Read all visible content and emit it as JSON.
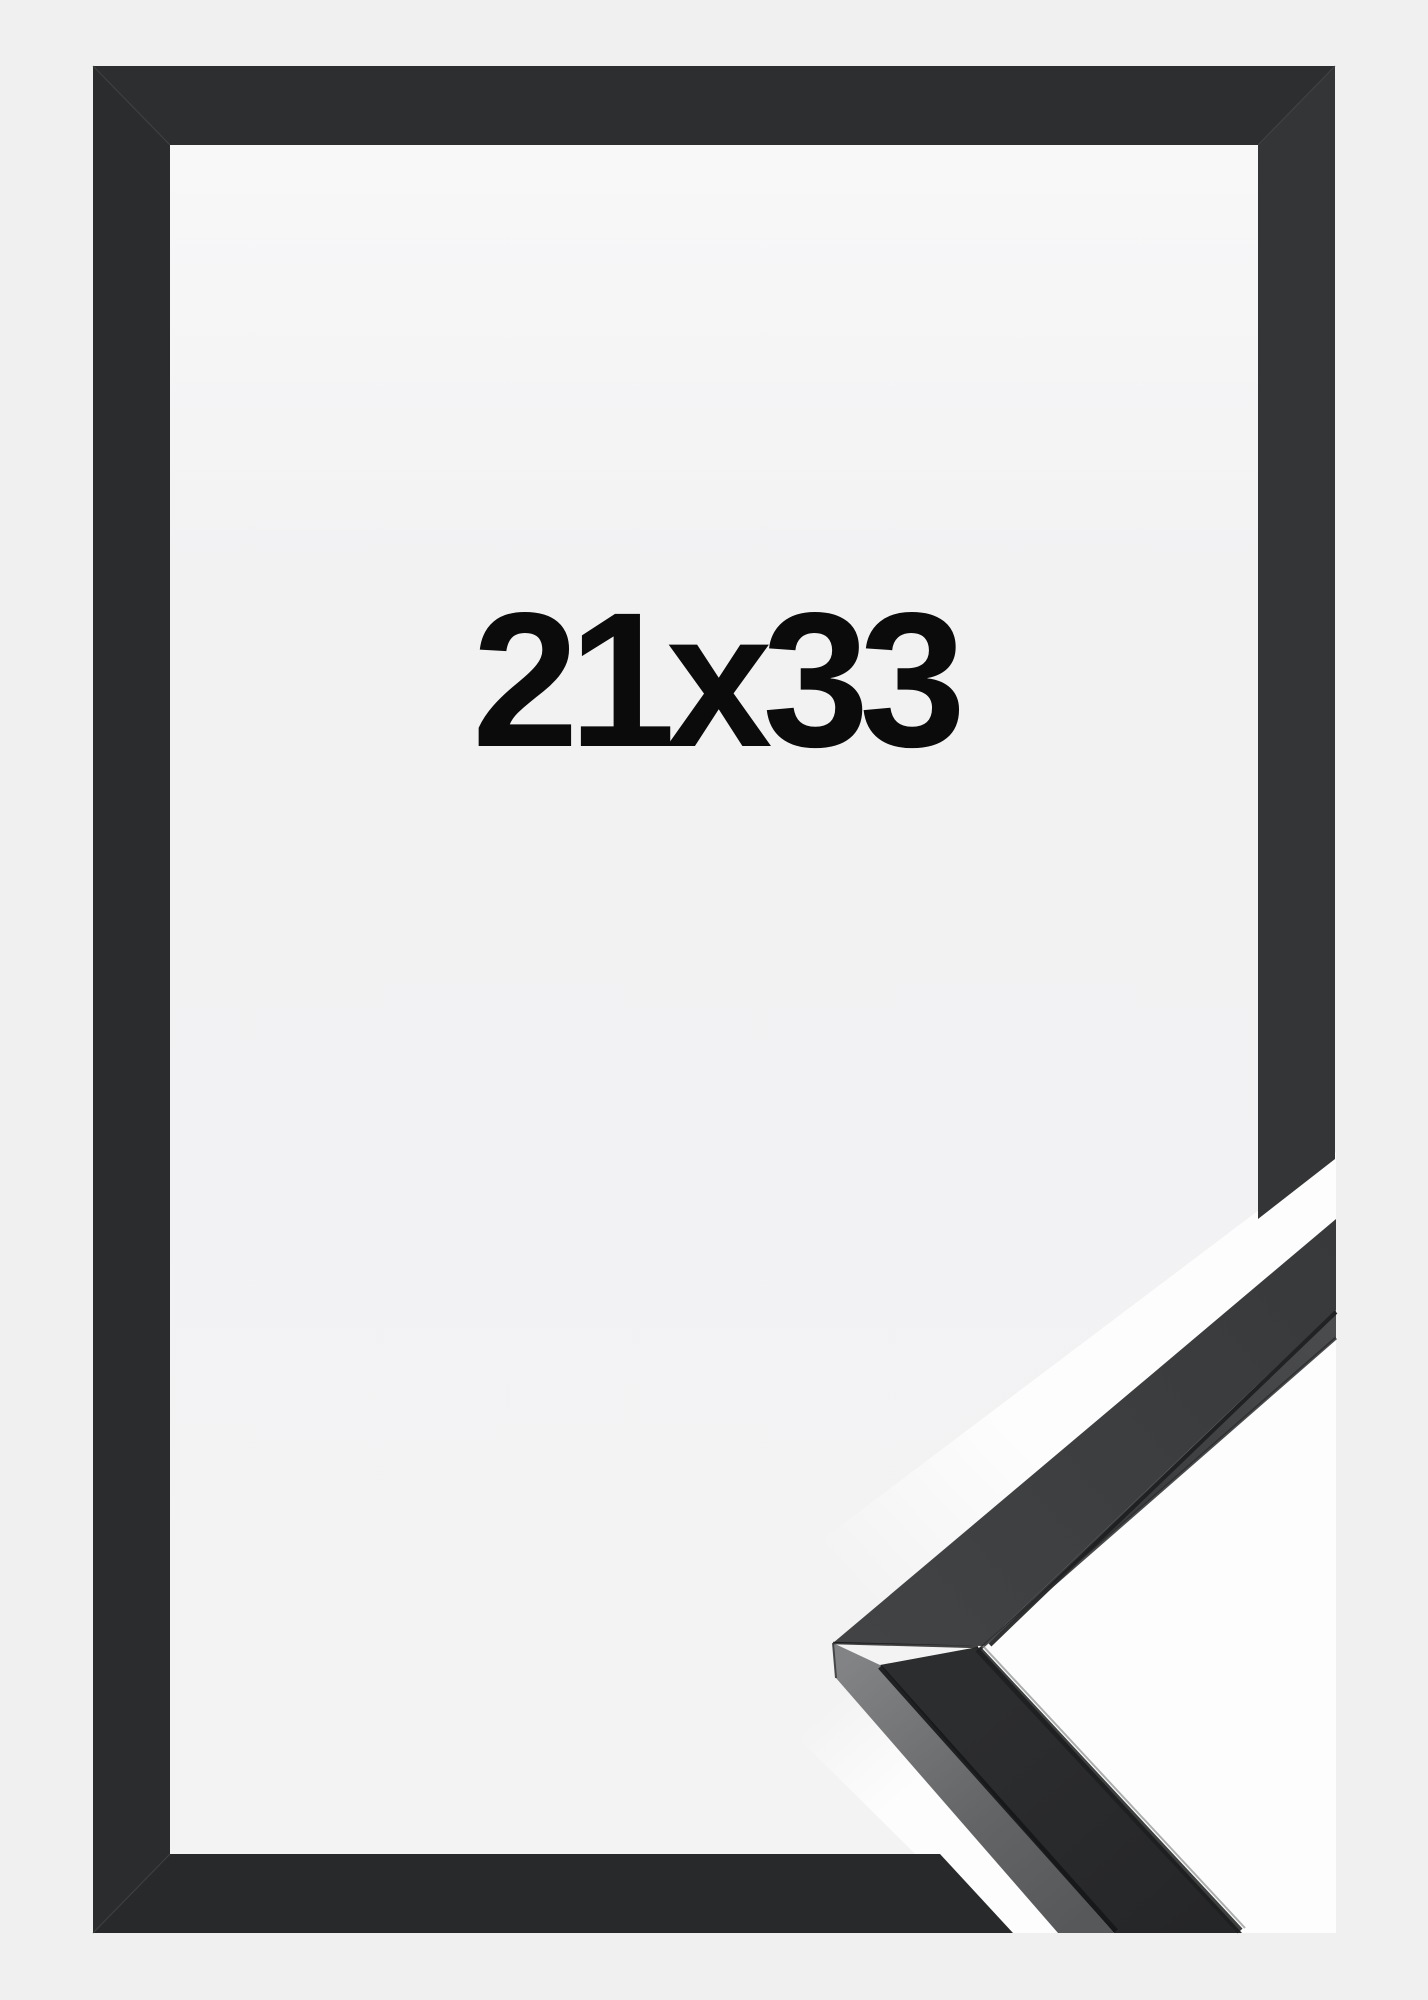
{
  "image": {
    "type": "framed-product-photo",
    "size_label": "21x33",
    "colors": {
      "page_background": "#f0f0f1",
      "interior_paper": "#f4f4f5",
      "frame_black_top": "#2d2e2f",
      "frame_black_left": "#2b2c2d",
      "frame_black_right": "#333537",
      "frame_black_bottom": "#28292a",
      "cutout_white": "#fdfdfd",
      "sample_face": "#3b3d3f",
      "sample_lip": "#48494b",
      "sample_bevel_light": "#7d7e80",
      "groove_dark": "#1d1e1f",
      "label_text": "#0b0b0b"
    }
  }
}
